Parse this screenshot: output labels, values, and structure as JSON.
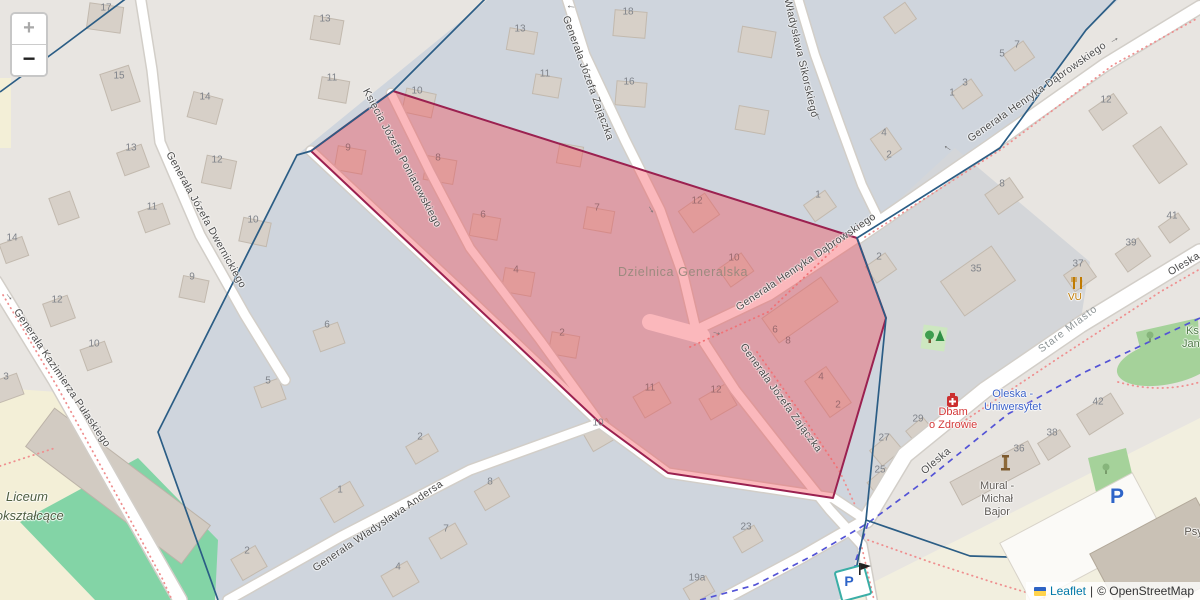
{
  "controls": {
    "zoom_in": "+",
    "zoom_out": "−"
  },
  "attribution": {
    "leaflet": "Leaflet",
    "separator": "|",
    "osm": "© OpenStreetMap"
  },
  "district": {
    "label": "Dzielnica Generalska"
  },
  "colors": {
    "district_fill": "rgba(244,68,80,0.38)",
    "district_border": "#9b2150",
    "boundary_navy": "#2b5d85",
    "path_red_dots": "#ef8f8f",
    "route_blue_dash": "#5353d6",
    "building_fill": "#d7d0c8",
    "building_stroke": "#c2b9ae",
    "road_fill": "#ffffff",
    "leaflet_link": "#0078A8"
  },
  "symbols": {
    "oneway_arrow": "→"
  },
  "pois": {
    "dbam": {
      "line1": "Dbam",
      "line2": "o Zdrowie"
    },
    "oleska_uni": {
      "line1": "Oleska -",
      "line2": "Uniwersytet"
    },
    "mural": {
      "line1": "Mural -",
      "line2": "Michał",
      "line3": "Bajor"
    },
    "vu": {
      "label": "VU"
    },
    "liceum": {
      "line1": "Liceum",
      "line2": "ogólnokształcące"
    },
    "wydzial": {
      "line1": "Wydział",
      "line2": "Psychologii",
      "line3": "Wydział",
      "line4": "Fizyki"
    },
    "ks_jan": {
      "line1": "Ks.",
      "line2": "Jan. I"
    },
    "parking_large": "P",
    "parking_small": "P"
  },
  "street_labels": [
    {
      "t": "Księcia Józefa Poniatowskiego",
      "x": 402,
      "y": 158,
      "r": 62
    },
    {
      "t": "Generała Józefa Zajączka",
      "x": 588,
      "y": 78,
      "r": 70
    },
    {
      "t": "Władysława Sikorskiego",
      "x": 801,
      "y": 58,
      "r": 77
    },
    {
      "t": "Generała Henryka Dąbrowskiego",
      "x": 1037,
      "y": 92,
      "r": -35
    },
    {
      "t": "Generała Henryka Dąbrowskiego",
      "x": 806,
      "y": 262,
      "r": -34
    },
    {
      "t": "Generała Józefa Zajączka",
      "x": 781,
      "y": 398,
      "r": 54
    },
    {
      "t": "Generała Józefa Dwernickiego",
      "x": 206,
      "y": 220,
      "r": 61
    },
    {
      "t": "Generała Kazimierza Pułaskiego",
      "x": 62,
      "y": 378,
      "r": 56
    },
    {
      "t": "Generała Władysława Andersa",
      "x": 378,
      "y": 526,
      "r": -34
    },
    {
      "t": "Oleska",
      "x": 936,
      "y": 461,
      "r": -40
    },
    {
      "t": "Oleska",
      "x": 1184,
      "y": 264,
      "r": -31
    },
    {
      "t": "Stare Miasto",
      "x": 1068,
      "y": 329,
      "r": -37,
      "f": true
    }
  ],
  "house_numbers": [
    {
      "t": "17",
      "x": 106,
      "y": 8
    },
    {
      "t": "15",
      "x": 119,
      "y": 76
    },
    {
      "t": "14",
      "x": 205,
      "y": 97
    },
    {
      "t": "13",
      "x": 131,
      "y": 148
    },
    {
      "t": "11",
      "x": 152,
      "y": 207
    },
    {
      "t": "12",
      "x": 217,
      "y": 160
    },
    {
      "t": "10",
      "x": 253,
      "y": 220
    },
    {
      "t": "9",
      "x": 192,
      "y": 277
    },
    {
      "t": "12",
      "x": 57,
      "y": 300
    },
    {
      "t": "10",
      "x": 94,
      "y": 344
    },
    {
      "t": "3",
      "x": 6,
      "y": 377
    },
    {
      "t": "14",
      "x": 12,
      "y": 238
    },
    {
      "t": "13",
      "x": 325,
      "y": 19
    },
    {
      "t": "11",
      "x": 332,
      "y": 78
    },
    {
      "t": "10",
      "x": 417,
      "y": 91
    },
    {
      "t": "13",
      "x": 520,
      "y": 29
    },
    {
      "t": "11",
      "x": 545,
      "y": 74
    },
    {
      "t": "18",
      "x": 628,
      "y": 12
    },
    {
      "t": "16",
      "x": 629,
      "y": 82
    },
    {
      "t": "1",
      "x": 818,
      "y": 195
    },
    {
      "t": "2",
      "x": 879,
      "y": 257
    },
    {
      "t": "4",
      "x": 884,
      "y": 133
    },
    {
      "t": "2",
      "x": 889,
      "y": 155
    },
    {
      "t": "7",
      "x": 1017,
      "y": 45
    },
    {
      "t": "5",
      "x": 1002,
      "y": 54
    },
    {
      "t": "3",
      "x": 965,
      "y": 83
    },
    {
      "t": "1",
      "x": 952,
      "y": 93
    },
    {
      "t": "12",
      "x": 1106,
      "y": 100
    },
    {
      "t": "8",
      "x": 1002,
      "y": 184
    },
    {
      "t": "39",
      "x": 1131,
      "y": 243
    },
    {
      "t": "37",
      "x": 1078,
      "y": 264
    },
    {
      "t": "41",
      "x": 1172,
      "y": 216
    },
    {
      "t": "35",
      "x": 976,
      "y": 269
    },
    {
      "t": "10",
      "x": 598,
      "y": 423
    },
    {
      "t": "8",
      "x": 490,
      "y": 482
    },
    {
      "t": "1",
      "x": 340,
      "y": 490
    },
    {
      "t": "7",
      "x": 446,
      "y": 529
    },
    {
      "t": "4",
      "x": 398,
      "y": 567
    },
    {
      "t": "6",
      "x": 327,
      "y": 325
    },
    {
      "t": "5",
      "x": 268,
      "y": 381
    },
    {
      "t": "2",
      "x": 247,
      "y": 551
    },
    {
      "t": "2",
      "x": 420,
      "y": 437
    },
    {
      "t": "27",
      "x": 884,
      "y": 438
    },
    {
      "t": "25",
      "x": 880,
      "y": 470
    },
    {
      "t": "19a",
      "x": 697,
      "y": 578
    },
    {
      "t": "23",
      "x": 746,
      "y": 527
    },
    {
      "t": "29",
      "x": 918,
      "y": 419
    },
    {
      "t": "42",
      "x": 1098,
      "y": 402
    },
    {
      "t": "38",
      "x": 1052,
      "y": 433
    },
    {
      "t": "36",
      "x": 1019,
      "y": 449
    },
    {
      "t": "9",
      "x": 348,
      "y": 148,
      "i": 1
    },
    {
      "t": "8",
      "x": 438,
      "y": 158,
      "i": 1
    },
    {
      "t": "6",
      "x": 483,
      "y": 215,
      "i": 1
    },
    {
      "t": "7",
      "x": 597,
      "y": 208,
      "i": 1
    },
    {
      "t": "4",
      "x": 516,
      "y": 270,
      "i": 1
    },
    {
      "t": "2",
      "x": 562,
      "y": 333,
      "i": 1
    },
    {
      "t": "12",
      "x": 697,
      "y": 201,
      "i": 1
    },
    {
      "t": "10",
      "x": 734,
      "y": 258,
      "i": 1
    },
    {
      "t": "11",
      "x": 650,
      "y": 388,
      "i": 1
    },
    {
      "t": "12",
      "x": 716,
      "y": 390,
      "i": 1
    },
    {
      "t": "6",
      "x": 775,
      "y": 330,
      "i": 1
    },
    {
      "t": "8",
      "x": 788,
      "y": 341,
      "i": 1
    },
    {
      "t": "4",
      "x": 821,
      "y": 377,
      "i": 1
    },
    {
      "t": "2",
      "x": 838,
      "y": 405,
      "i": 1
    }
  ],
  "oneway_arrows": [
    {
      "x": 571,
      "y": 8,
      "r": 185
    },
    {
      "x": 817,
      "y": 117,
      "r": 250
    },
    {
      "x": 10,
      "y": 296,
      "r": 50
    },
    {
      "x": 947,
      "y": 149,
      "r": 213
    },
    {
      "x": 1114,
      "y": 39,
      "r": -30
    },
    {
      "x": 652,
      "y": 209,
      "r": 60
    },
    {
      "x": 717,
      "y": 332,
      "r": 15
    }
  ],
  "buildings": [
    {
      "x": 105,
      "y": 18,
      "w": 34,
      "h": 26,
      "r": 8
    },
    {
      "x": 120,
      "y": 88,
      "w": 30,
      "h": 38,
      "r": -18
    },
    {
      "x": 205,
      "y": 108,
      "w": 30,
      "h": 26,
      "r": 15
    },
    {
      "x": 133,
      "y": 160,
      "w": 26,
      "h": 24,
      "r": -20
    },
    {
      "x": 154,
      "y": 218,
      "w": 26,
      "h": 22,
      "r": -20
    },
    {
      "x": 219,
      "y": 172,
      "w": 30,
      "h": 28,
      "r": 12
    },
    {
      "x": 255,
      "y": 232,
      "w": 28,
      "h": 24,
      "r": 12
    },
    {
      "x": 194,
      "y": 289,
      "w": 26,
      "h": 22,
      "r": 12
    },
    {
      "x": 59,
      "y": 311,
      "w": 26,
      "h": 24,
      "r": -20
    },
    {
      "x": 96,
      "y": 356,
      "w": 26,
      "h": 22,
      "r": -20
    },
    {
      "x": 8,
      "y": 388,
      "w": 26,
      "h": 22,
      "r": -20
    },
    {
      "x": 14,
      "y": 250,
      "w": 24,
      "h": 20,
      "r": -20
    },
    {
      "x": 64,
      "y": 208,
      "w": 22,
      "h": 28,
      "r": -20
    },
    {
      "x": 327,
      "y": 30,
      "w": 30,
      "h": 24,
      "r": 10
    },
    {
      "x": 334,
      "y": 90,
      "w": 28,
      "h": 22,
      "r": 10
    },
    {
      "x": 419,
      "y": 103,
      "w": 30,
      "h": 24,
      "r": 12
    },
    {
      "x": 522,
      "y": 41,
      "w": 28,
      "h": 22,
      "r": 10
    },
    {
      "x": 547,
      "y": 86,
      "w": 26,
      "h": 20,
      "r": 10
    },
    {
      "x": 630,
      "y": 24,
      "w": 32,
      "h": 26,
      "r": 5
    },
    {
      "x": 631,
      "y": 94,
      "w": 30,
      "h": 24,
      "r": 5
    },
    {
      "x": 757,
      "y": 42,
      "w": 34,
      "h": 26,
      "r": 10
    },
    {
      "x": 752,
      "y": 120,
      "w": 30,
      "h": 24,
      "r": 10
    },
    {
      "x": 900,
      "y": 18,
      "w": 26,
      "h": 20,
      "r": -35
    },
    {
      "x": 820,
      "y": 206,
      "w": 26,
      "h": 20,
      "r": -35
    },
    {
      "x": 881,
      "y": 268,
      "w": 24,
      "h": 20,
      "r": -35
    },
    {
      "x": 886,
      "y": 144,
      "w": 20,
      "h": 26,
      "r": -35
    },
    {
      "x": 1019,
      "y": 56,
      "w": 24,
      "h": 20,
      "r": -35
    },
    {
      "x": 967,
      "y": 94,
      "w": 24,
      "h": 20,
      "r": -35
    },
    {
      "x": 1108,
      "y": 112,
      "w": 30,
      "h": 24,
      "r": -35
    },
    {
      "x": 1004,
      "y": 196,
      "w": 30,
      "h": 24,
      "r": -35
    },
    {
      "x": 1133,
      "y": 255,
      "w": 28,
      "h": 22,
      "r": -35
    },
    {
      "x": 1174,
      "y": 228,
      "w": 24,
      "h": 20,
      "r": -35
    },
    {
      "x": 978,
      "y": 281,
      "w": 62,
      "h": 42,
      "r": -35
    },
    {
      "x": 1080,
      "y": 276,
      "w": 26,
      "h": 20,
      "r": -35
    },
    {
      "x": 1160,
      "y": 155,
      "w": 34,
      "h": 46,
      "r": -35
    },
    {
      "x": 600,
      "y": 435,
      "w": 28,
      "h": 22,
      "r": -30
    },
    {
      "x": 492,
      "y": 494,
      "w": 28,
      "h": 22,
      "r": -30
    },
    {
      "x": 342,
      "y": 502,
      "w": 34,
      "h": 28,
      "r": -30
    },
    {
      "x": 448,
      "y": 541,
      "w": 30,
      "h": 24,
      "r": -30
    },
    {
      "x": 400,
      "y": 579,
      "w": 30,
      "h": 24,
      "r": -30
    },
    {
      "x": 329,
      "y": 337,
      "w": 26,
      "h": 22,
      "r": -20
    },
    {
      "x": 270,
      "y": 393,
      "w": 26,
      "h": 22,
      "r": -20
    },
    {
      "x": 249,
      "y": 563,
      "w": 28,
      "h": 24,
      "r": -30
    },
    {
      "x": 422,
      "y": 449,
      "w": 26,
      "h": 20,
      "r": -30
    },
    {
      "x": 886,
      "y": 450,
      "w": 26,
      "h": 20,
      "r": -40
    },
    {
      "x": 882,
      "y": 482,
      "w": 24,
      "h": 18,
      "r": -40
    },
    {
      "x": 699,
      "y": 590,
      "w": 26,
      "h": 18,
      "r": -30
    },
    {
      "x": 748,
      "y": 539,
      "w": 24,
      "h": 18,
      "r": -30
    },
    {
      "x": 920,
      "y": 431,
      "w": 22,
      "h": 18,
      "r": -40
    },
    {
      "x": 1100,
      "y": 414,
      "w": 40,
      "h": 24,
      "r": -32
    },
    {
      "x": 1054,
      "y": 445,
      "w": 26,
      "h": 20,
      "r": -32
    },
    {
      "x": 1021,
      "y": 461,
      "w": 26,
      "h": 20,
      "r": -32
    },
    {
      "x": 350,
      "y": 160,
      "w": 28,
      "h": 24,
      "r": 10
    },
    {
      "x": 440,
      "y": 170,
      "w": 30,
      "h": 24,
      "r": 10
    },
    {
      "x": 485,
      "y": 227,
      "w": 28,
      "h": 22,
      "r": 10
    },
    {
      "x": 599,
      "y": 220,
      "w": 28,
      "h": 22,
      "r": 10
    },
    {
      "x": 518,
      "y": 282,
      "w": 30,
      "h": 24,
      "r": 10
    },
    {
      "x": 564,
      "y": 345,
      "w": 28,
      "h": 22,
      "r": 10
    },
    {
      "x": 570,
      "y": 155,
      "w": 24,
      "h": 20,
      "r": 10
    },
    {
      "x": 699,
      "y": 213,
      "w": 32,
      "h": 26,
      "r": -35
    },
    {
      "x": 736,
      "y": 270,
      "w": 28,
      "h": 22,
      "r": -35
    },
    {
      "x": 652,
      "y": 400,
      "w": 30,
      "h": 24,
      "r": -30
    },
    {
      "x": 718,
      "y": 402,
      "w": 30,
      "h": 24,
      "r": -30
    },
    {
      "x": 800,
      "y": 310,
      "w": 72,
      "h": 30,
      "r": -35
    },
    {
      "x": 828,
      "y": 392,
      "w": 26,
      "h": 44,
      "r": -35
    },
    {
      "x": 118,
      "y": 486,
      "w": 195,
      "h": 48,
      "r": 37,
      "f": "#d2cbc2",
      "s": "#bcb3a8"
    },
    {
      "x": 1082,
      "y": 538,
      "w": 150,
      "h": 68,
      "r": -28,
      "f": "#fbfaf7",
      "s": "#d8d3c9",
      "l": 2
    },
    {
      "x": 1162,
      "y": 562,
      "w": 120,
      "h": 82,
      "r": -28,
      "f": "#c9c1b5",
      "s": "#b2a899",
      "l": 2
    },
    {
      "x": 995,
      "y": 473,
      "w": 88,
      "h": 26,
      "r": -28,
      "f": "#d8d1c9",
      "s": "#c0b7ac",
      "l": 2
    }
  ]
}
